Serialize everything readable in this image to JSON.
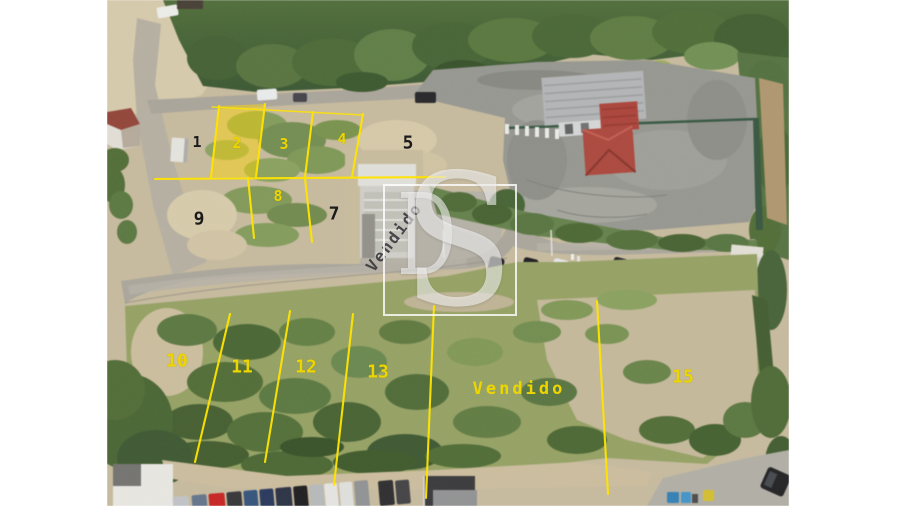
{
  "photo": {
    "description": "Aerial drone photo of numbered land lots for sale with yellow plot boundary lines"
  },
  "watermark": {
    "d": "D",
    "s": "S"
  },
  "labels": {
    "sold_rotated": "Vendido",
    "sold_field": "Vendido"
  },
  "lots": [
    {
      "label": "1",
      "tone": "dark"
    },
    {
      "label": "2",
      "tone": "yellow",
      "highlighted": true
    },
    {
      "label": "3",
      "tone": "yellow"
    },
    {
      "label": "4",
      "tone": "yellow"
    },
    {
      "label": "5",
      "tone": "dark"
    },
    {
      "label": "7",
      "tone": "dark"
    },
    {
      "label": "8",
      "tone": "yellow"
    },
    {
      "label": "9",
      "tone": "dark"
    },
    {
      "label": "10",
      "tone": "yellow"
    },
    {
      "label": "11",
      "tone": "yellow"
    },
    {
      "label": "12",
      "tone": "yellow"
    },
    {
      "label": "13",
      "tone": "yellow"
    },
    {
      "label": "15",
      "tone": "yellow"
    }
  ],
  "theme": {
    "canvas_bg": "#ffffff",
    "line_yellow": "#ffe400",
    "label_yellow": "#edd600",
    "label_dark": "#1b1b1b",
    "highlight_fill": "rgba(255,214,0,0.45)",
    "watermark_white": "rgba(255,255,255,0.55)"
  }
}
